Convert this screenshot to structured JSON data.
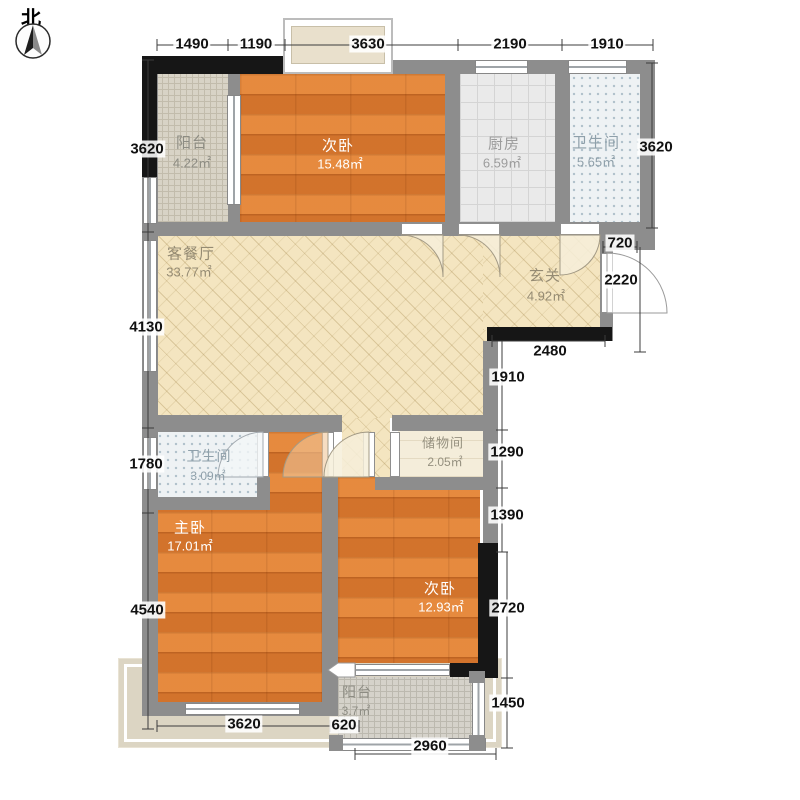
{
  "compass": {
    "label": "北"
  },
  "rooms": [
    {
      "id": "balcony-top",
      "name": "阳台",
      "area": "4.22㎡"
    },
    {
      "id": "bedroom-top",
      "name": "次卧",
      "area": "15.48㎡"
    },
    {
      "id": "kitchen",
      "name": "厨房",
      "area": "6.59㎡"
    },
    {
      "id": "bathroom-top",
      "name": "卫生间",
      "area": "5.65㎡"
    },
    {
      "id": "living-dining",
      "name": "客餐厅",
      "area": "33.77㎡"
    },
    {
      "id": "entry-hall",
      "name": "玄关",
      "area": "4.92㎡"
    },
    {
      "id": "storage-room",
      "name": "储物间",
      "area": "2.05㎡"
    },
    {
      "id": "bathroom-bottom",
      "name": "卫生间",
      "area": "3.09㎡"
    },
    {
      "id": "master-bedroom",
      "name": "主卧",
      "area": "17.01㎡"
    },
    {
      "id": "bedroom-bottom",
      "name": "次卧",
      "area": "12.93㎡"
    },
    {
      "id": "balcony-bottom",
      "name": "阳台",
      "area": "3.7㎡"
    }
  ],
  "dimensions": {
    "top": [
      "1490",
      "1190",
      "3630",
      "2190",
      "1910"
    ],
    "left": [
      "3620",
      "4130",
      "1780",
      "4540"
    ],
    "right": [
      "3620",
      "720",
      "2220",
      "2480",
      "1910",
      "1290",
      "1390",
      "2720",
      "1450"
    ],
    "bottom": [
      "3620",
      "620",
      "2960"
    ]
  },
  "colors": {
    "wall": "#8d8d8d",
    "wall_dark": "#161616",
    "bedroom_floor": "#dc7d34",
    "living_floor": "#f4e5c0",
    "kitchen_floor": "#eaeaea",
    "bath_floor": "#eef2f4",
    "balcony_floor": "#d8d3c6",
    "storage_floor": "#f4edda",
    "terrace": "#dcd5c3",
    "dimension_text": "#111111"
  }
}
